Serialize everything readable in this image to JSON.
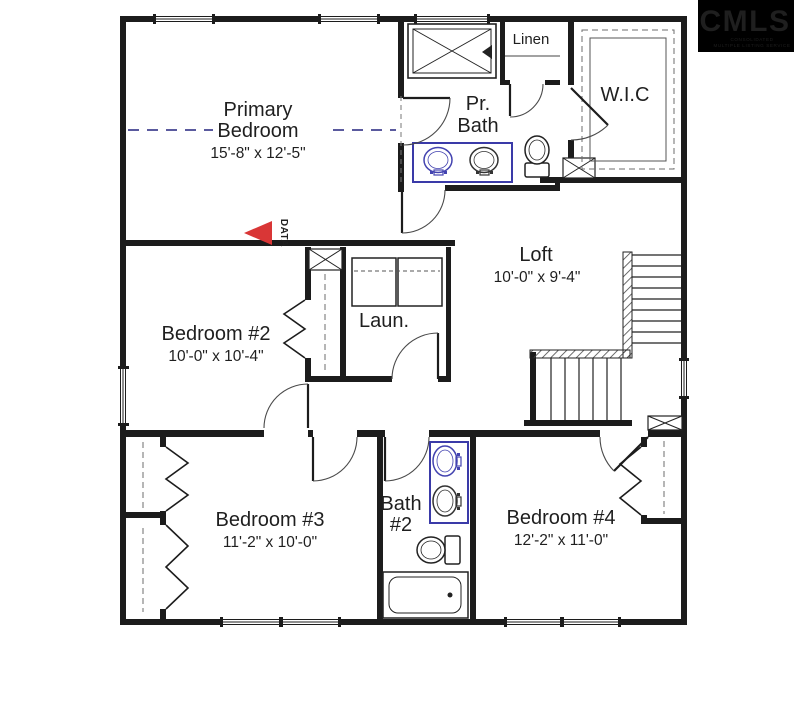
{
  "logo": {
    "name": "CMLS",
    "tagline1": "CONSOLIDATED",
    "tagline2": "MULTIPLE LISTING SERVICE"
  },
  "rooms": {
    "primary_bedroom": {
      "line1": "Primary",
      "line2": "Bedroom",
      "dims": "15'-8\" x 12'-5\""
    },
    "pr_bath": {
      "line1": "Pr.",
      "line2": "Bath"
    },
    "linen": {
      "label": "Linen"
    },
    "wic": {
      "label": "W.I.C"
    },
    "loft": {
      "label": "Loft",
      "dims": "10'-0\" x 9'-4\""
    },
    "bedroom2": {
      "label": "Bedroom #2",
      "dims": "10'-0\" x 10'-4\""
    },
    "laundry": {
      "label": "Laun."
    },
    "bedroom3": {
      "label": "Bedroom #3",
      "dims": "11'-2\" x 10'-0\""
    },
    "bath2": {
      "line1": "Bath",
      "line2": "#2"
    },
    "bedroom4": {
      "label": "Bedroom #4",
      "dims": "12'-2\" x 11'-0\""
    }
  },
  "annotations": {
    "data_marker": "DATA"
  },
  "colors": {
    "wall": "#1c1c1c",
    "fixture_highlight": "#3a3aa8",
    "room_divider_dash": "#5a5a9e",
    "data_marker": "#d93636",
    "logo_bg": "#000000",
    "logo_text": "#ffffff"
  }
}
